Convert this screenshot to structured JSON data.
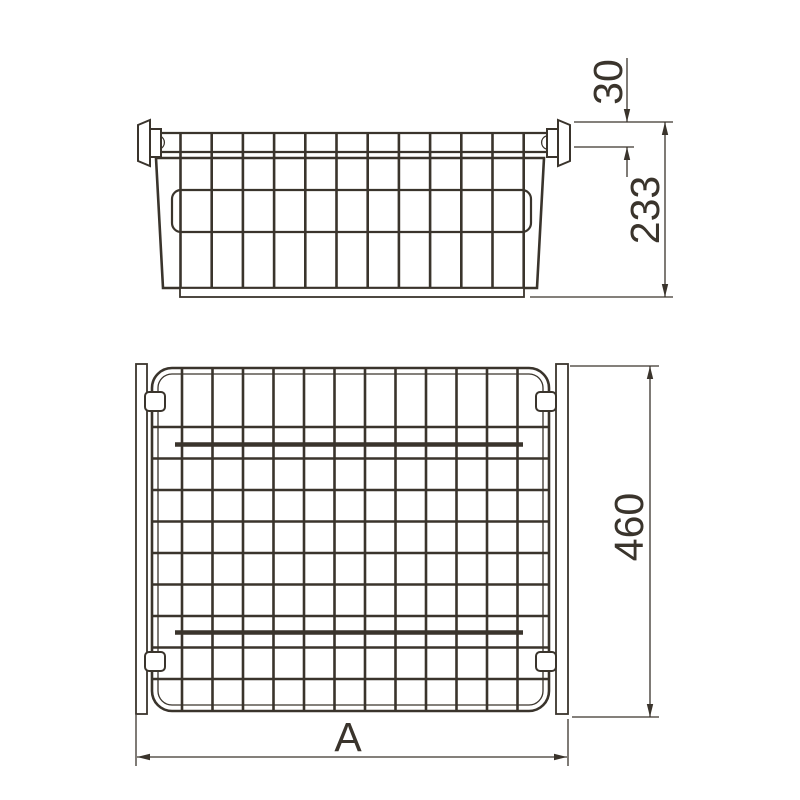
{
  "drawing": {
    "title": "wire-basket-technical-drawing",
    "line_color": "#3a342c",
    "background_color": "#ffffff",
    "views": {
      "front": {
        "name": "basket-front-elevation"
      },
      "plan": {
        "name": "basket-top-view"
      }
    },
    "dimensions": {
      "rail_offset": {
        "label": "30"
      },
      "height": {
        "label": "233"
      },
      "depth": {
        "label": "460"
      },
      "width": {
        "label": "A"
      }
    }
  }
}
